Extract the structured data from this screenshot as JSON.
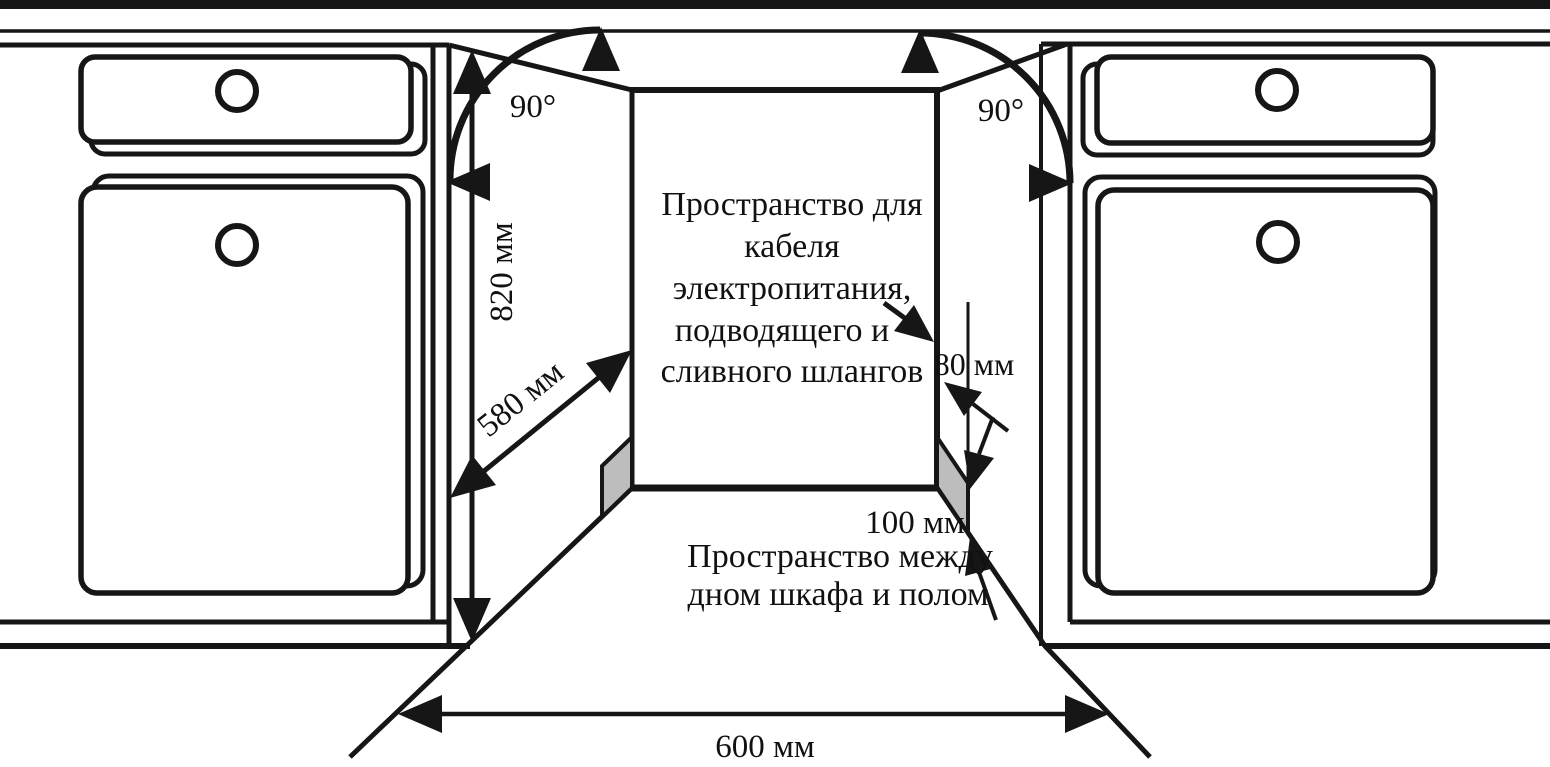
{
  "diagram": {
    "type": "installation-drawing",
    "subject": "built-in dishwasher niche between kitchen cabinets",
    "colors": {
      "line": "#161616",
      "shade": "#bdbdbd",
      "background": "#ffffff",
      "text": "#111111"
    },
    "labels": {
      "angle_left": "90°",
      "angle_right": "90°",
      "niche_height": "820 мм",
      "niche_depth": "580 мм",
      "niche_width": "600 мм",
      "rear_gap": "80 мм",
      "floor_gap": "100 мм"
    },
    "annotations": {
      "rear_space_note": {
        "lines": [
          "Пространство для",
          "кабеля",
          "электропитания,",
          "подводящего и",
          "сливного шлангов"
        ]
      },
      "floor_space_note": {
        "lines": [
          "Пространство между",
          "дном шкафа и полом"
        ]
      }
    }
  }
}
